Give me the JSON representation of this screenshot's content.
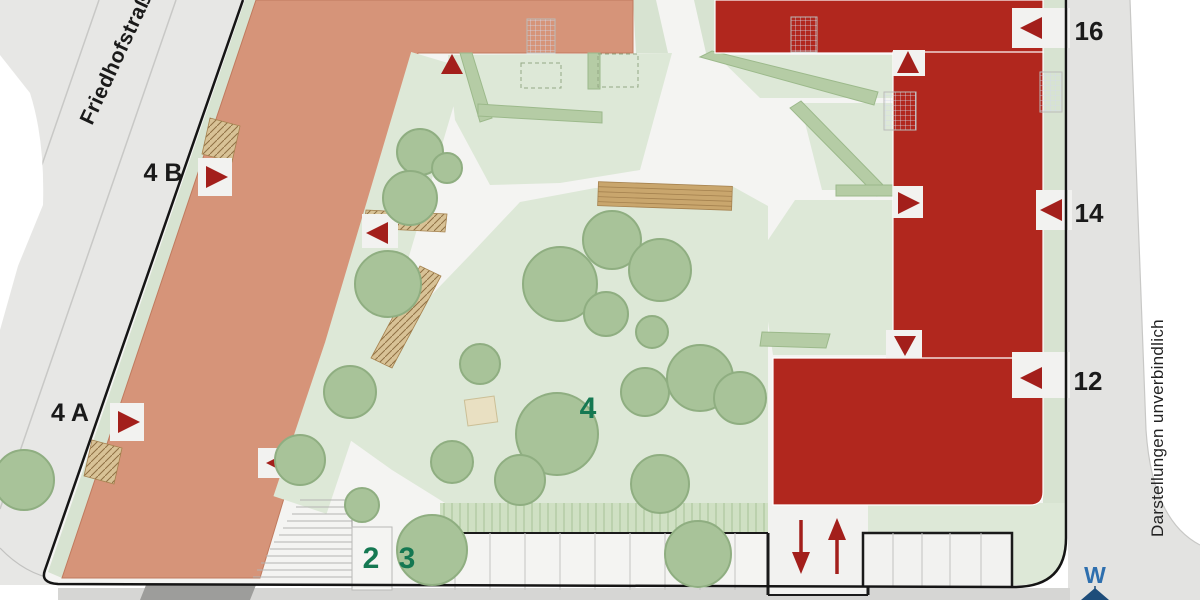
{
  "plan": {
    "street": {
      "label": "Friedhofstraße"
    },
    "disclaimer": {
      "label": "Darstellungen unverbindlich"
    },
    "compass": {
      "label": "W"
    },
    "west_building": {
      "entrance_labels": [
        "4 B",
        "4 A"
      ]
    },
    "east_building": {
      "unit_labels": [
        "16",
        "14",
        "12"
      ]
    },
    "courtyard": {
      "area_labels": [
        "2",
        "3",
        "4"
      ]
    },
    "ramp": {
      "direction_arrows": [
        "down",
        "up"
      ]
    },
    "colors": {
      "west_building": "#d69479",
      "east_building": "#b1271e",
      "lawn": "#dde8d7",
      "tree": "#a8c399",
      "marker_red": "#a31f1b",
      "label_green": "#157852",
      "compass_blue": "#2e6fae",
      "boundary": "#151515"
    }
  }
}
